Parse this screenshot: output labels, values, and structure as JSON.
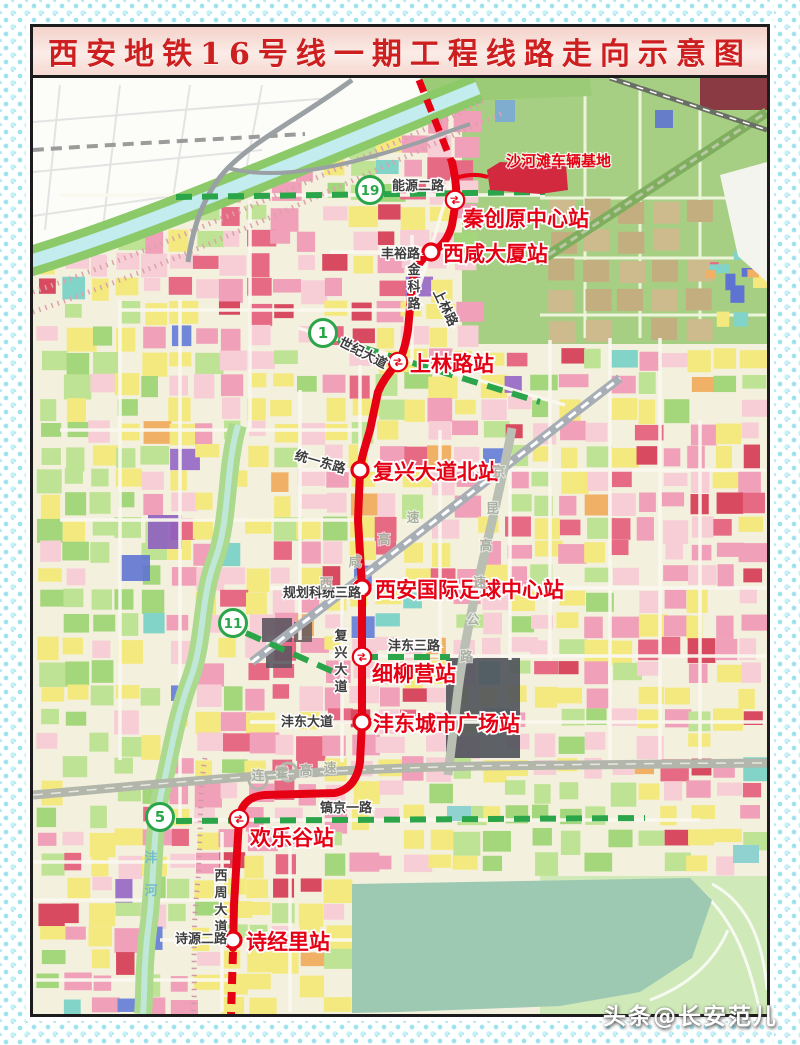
{
  "title": "西安地铁16号线一期工程线路走向示意图",
  "watermark": "头条@长安范儿",
  "line16": {
    "name": "地铁16号线一期",
    "color": "#e60014"
  },
  "depot": {
    "label": "沙河滩车辆基地"
  },
  "stations": [
    {
      "name": "秦创原中心站",
      "transfer": true
    },
    {
      "name": "西咸大厦站",
      "transfer": false
    },
    {
      "name": "上林路站",
      "transfer": true
    },
    {
      "name": "复兴大道北站",
      "transfer": false
    },
    {
      "name": "西安国际足球中心站",
      "transfer": false
    },
    {
      "name": "细柳营站",
      "transfer": true
    },
    {
      "name": "沣东城市广场站",
      "transfer": false
    },
    {
      "name": "欢乐谷站",
      "transfer": true
    },
    {
      "name": "诗经里站",
      "transfer": false
    }
  ],
  "connecting_lines": [
    {
      "number": "19",
      "color": "#2aa549"
    },
    {
      "number": "1",
      "color": "#2aa549"
    },
    {
      "number": "11",
      "color": "#2aa549"
    },
    {
      "number": "5",
      "color": "#2aa549"
    }
  ],
  "roads": [
    "能源二路",
    "丰裕路",
    "金科路",
    "上林路",
    "世纪大道",
    "统一东路",
    "规划科统三路",
    "复兴大道",
    "沣东三路",
    "沣东大道",
    "镐京一路",
    "西周大道",
    "诗源二路"
  ],
  "expressways": [
    "西咸高速",
    "京昆高速公路",
    "连霍高速"
  ],
  "river": "沣河"
}
